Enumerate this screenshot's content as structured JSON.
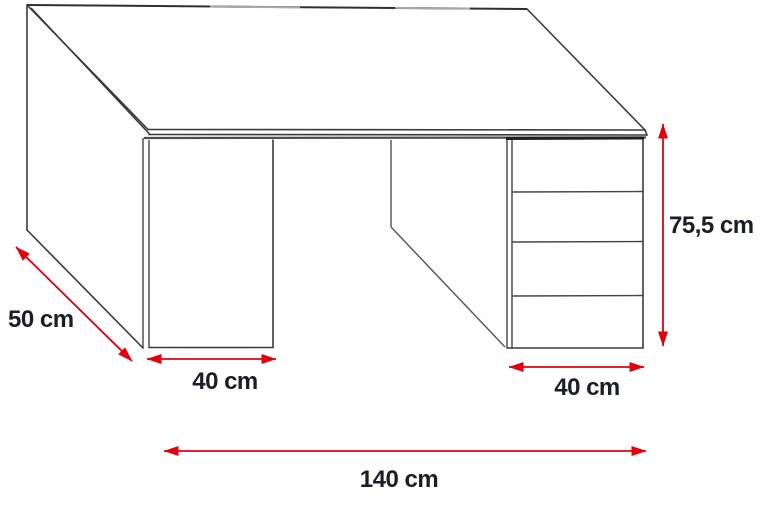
{
  "diagram": {
    "type": "furniture-dimension-diagram",
    "subject": "computer desk line drawing with left pedestal and 4-drawer unit",
    "drawer_count": 4
  },
  "colors": {
    "dimension_red": "#e2000f",
    "label_text": "#1d1d26",
    "line_dark": "#3a3a3a",
    "line_gray": "#a8a8a8",
    "bg": "#ffffff"
  },
  "dimensions": {
    "depth": {
      "label": "50 cm"
    },
    "left_pedestal_width": {
      "label": "40 cm"
    },
    "drawer_unit_width": {
      "label": "40 cm"
    },
    "total_width": {
      "label": "140 cm"
    },
    "height": {
      "label": "75,5 cm"
    }
  }
}
